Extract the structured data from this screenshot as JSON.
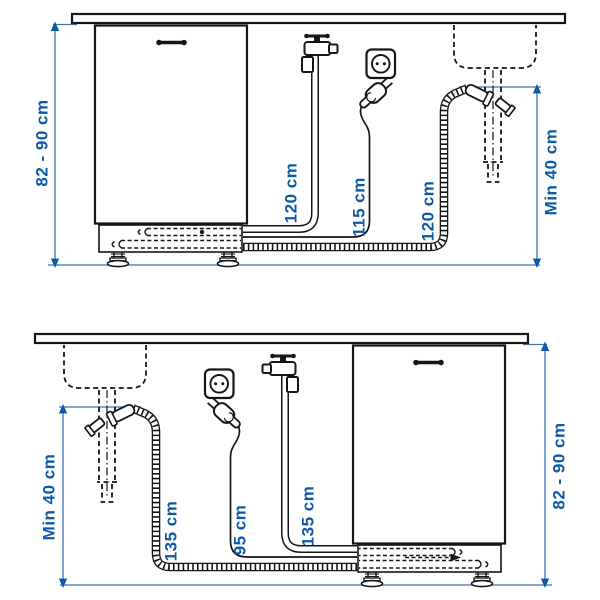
{
  "figure": {
    "type": "installation-diagram",
    "subject": "dishwasher-hose-and-cord-clearances",
    "accent_color": "#0d59a5",
    "line_color": "#161616",
    "background_color": "#ffffff"
  },
  "diagrams": {
    "top": {
      "layout": "dishwasher-left-sink-right",
      "cabinet_height_label": "82 - 90 cm",
      "supply_hose_label": "120 cm",
      "power_cord_label": "115 cm",
      "drain_hose_label": "120 cm",
      "drain_height_label": "Min 40 cm"
    },
    "bottom": {
      "layout": "sink-left-dishwasher-right",
      "drain_height_label": "Min 40 cm",
      "drain_hose_label": "135 cm",
      "power_cord_label": "95 cm",
      "supply_hose_label": "135 cm",
      "cabinet_height_label": "82 - 90 cm"
    }
  }
}
